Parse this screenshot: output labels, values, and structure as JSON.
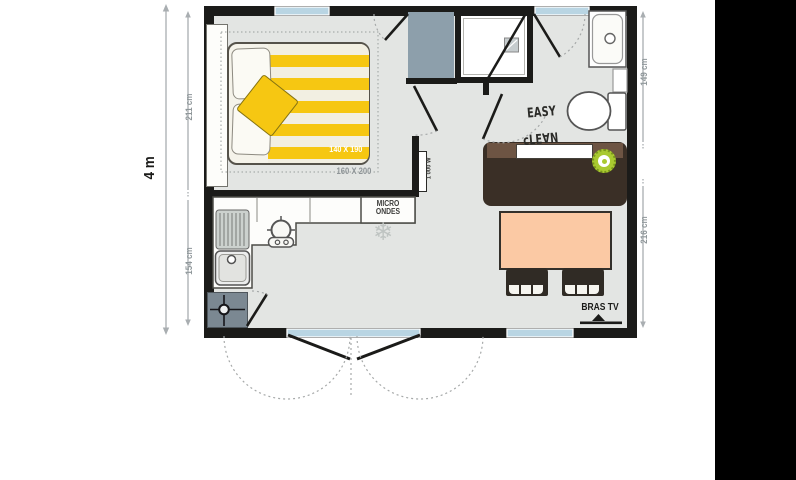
{
  "floor_plan": {
    "overall_width_label": "4 m",
    "dimensions": {
      "bedroom_depth": "211 cm",
      "kitchen_depth": "154 cm",
      "bathroom_depth": "149 cm",
      "living_depth": "216 cm"
    },
    "bedroom": {
      "bed_size_label": "140 X 190",
      "bed_option_label": "160 X 200"
    },
    "kitchen": {
      "microwave_label": "MICRO\nONDES"
    },
    "hall": {
      "heater_power_label": "1 000 W"
    },
    "living": {
      "tv_bracket_label": "BRAS TV"
    },
    "branding": {
      "logo_line1": "EASY",
      "logo_line2": "cLE∀N"
    },
    "icons": {
      "snowflake": "❄"
    },
    "colors": {
      "wall": "#1b1b19",
      "floor": "#e3e5e3",
      "window_glass": "#b9d5e3",
      "bed_stripe_yellow": "#f6c712",
      "bed_stripe_cream": "#f2efe2",
      "table_peach": "#fbc9a4",
      "counter_dark_brown": "#3a2f26",
      "counter_brown": "#6d5443",
      "stool_green": "#a9c930",
      "wardrobe_gray": "#8d9fab",
      "boiler_gray": "#7b8892",
      "dimension_gray": "#8f979a"
    }
  }
}
